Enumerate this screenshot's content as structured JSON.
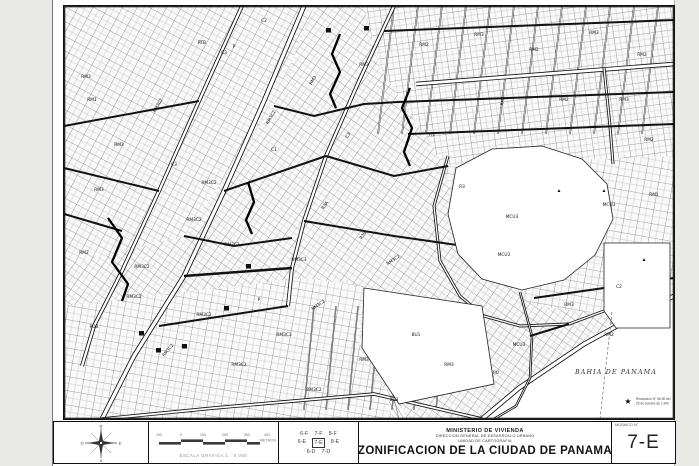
{
  "page": {
    "bg": "#e9e9e6",
    "sheet_bg": "#ffffff",
    "ink": "#1a1a1a"
  },
  "map": {
    "width": 610,
    "height": 413,
    "bay": {
      "label": "BAHIA DE PANAMA",
      "lx": 552,
      "ly": 368,
      "pts": [
        [
          418,
          413
        ],
        [
          452,
          384
        ],
        [
          505,
          344
        ],
        [
          562,
          310
        ],
        [
          610,
          286
        ],
        [
          610,
          413
        ]
      ]
    },
    "note": {
      "star": "★",
      "line1": "Resolucion N° 55-90 del",
      "line2": "26 de octubre de 1,990",
      "x": 564,
      "y": 394
    },
    "patterns": [
      {
        "id": "p1",
        "s": 13,
        "rot": 28
      },
      {
        "id": "p2",
        "s": 12,
        "rot": -8
      },
      {
        "id": "p3",
        "s": 12,
        "rot": 35
      },
      {
        "id": "p4",
        "s": 14,
        "rot": 10
      }
    ],
    "districts": [
      {
        "pat": "p3",
        "pts": [
          [
            0,
            0
          ],
          [
            610,
            0
          ],
          [
            610,
            413
          ],
          [
            0,
            413
          ]
        ]
      },
      {
        "pat": "p1",
        "pts": [
          [
            0,
            0
          ],
          [
            250,
            0
          ],
          [
            210,
            100
          ],
          [
            120,
            230
          ],
          [
            0,
            260
          ]
        ]
      },
      {
        "pat": "p2",
        "pts": [
          [
            300,
            0
          ],
          [
            610,
            0
          ],
          [
            610,
            150
          ],
          [
            380,
            160
          ],
          [
            315,
            60
          ]
        ]
      },
      {
        "pat": "p4",
        "pts": [
          [
            380,
            160
          ],
          [
            610,
            150
          ],
          [
            610,
            285
          ],
          [
            560,
            310
          ],
          [
            470,
            300
          ],
          [
            400,
            240
          ]
        ]
      },
      {
        "pat": "p4",
        "pts": [
          [
            0,
            300
          ],
          [
            240,
            272
          ],
          [
            300,
            280
          ],
          [
            295,
            340
          ],
          [
            330,
            400
          ],
          [
            330,
            413
          ],
          [
            0,
            413
          ]
        ]
      }
    ],
    "open_areas": [
      {
        "name": "park",
        "pts": [
          [
            392,
            162
          ],
          [
            428,
            143
          ],
          [
            478,
            140
          ],
          [
            518,
            153
          ],
          [
            543,
            178
          ],
          [
            549,
            213
          ],
          [
            531,
            249
          ],
          [
            500,
            274
          ],
          [
            458,
            284
          ],
          [
            418,
            273
          ],
          [
            394,
            248
          ],
          [
            384,
            208
          ]
        ]
      },
      {
        "name": "valley",
        "pts": [
          [
            300,
            282
          ],
          [
            418,
            300
          ],
          [
            430,
            378
          ],
          [
            335,
            398
          ],
          [
            298,
            342
          ]
        ]
      },
      {
        "name": "convention-block",
        "pts": [
          [
            540,
            237
          ],
          [
            606,
            237
          ],
          [
            606,
            322
          ],
          [
            552,
            322
          ],
          [
            540,
            305
          ]
        ]
      }
    ],
    "river": {
      "pts": [
        [
          318,
          288
        ],
        [
          310,
          310
        ],
        [
          318,
          335
        ],
        [
          330,
          358
        ],
        [
          328,
          385
        ],
        [
          335,
          413
        ]
      ]
    },
    "streams": [
      {
        "p": [
          [
            276,
            28
          ],
          [
            268,
            48
          ],
          [
            276,
            66
          ],
          [
            266,
            88
          ],
          [
            272,
            102
          ]
        ]
      },
      {
        "p": [
          [
            346,
            82
          ],
          [
            338,
            102
          ],
          [
            348,
            122
          ],
          [
            340,
            146
          ],
          [
            346,
            160
          ]
        ]
      },
      {
        "p": [
          [
            44,
            212
          ],
          [
            58,
            232
          ],
          [
            48,
            256
          ],
          [
            64,
            278
          ],
          [
            58,
            295
          ]
        ]
      },
      {
        "p": [
          [
            184,
            176
          ],
          [
            190,
            196
          ],
          [
            182,
            214
          ],
          [
            188,
            228
          ]
        ]
      }
    ],
    "roads": [
      {
        "w": 5,
        "d": 1,
        "p": [
          [
            240,
            0
          ],
          [
            200,
            95
          ],
          [
            160,
            185
          ],
          [
            120,
            270
          ],
          [
            70,
            350
          ],
          [
            38,
            413
          ]
        ]
      },
      {
        "w": 4,
        "d": 1,
        "p": [
          [
            178,
            0
          ],
          [
            135,
            95
          ],
          [
            95,
            185
          ],
          [
            58,
            265
          ],
          [
            30,
            320
          ],
          [
            18,
            360
          ]
        ]
      },
      {
        "w": 4,
        "d": 1,
        "p": [
          [
            330,
            0
          ],
          [
            295,
            75
          ],
          [
            262,
            150
          ],
          [
            240,
            215
          ],
          [
            228,
            262
          ],
          [
            224,
            300
          ]
        ]
      },
      {
        "w": 4.5,
        "d": 1,
        "p": [
          [
            352,
            78
          ],
          [
            610,
            58
          ]
        ]
      },
      {
        "w": 5,
        "d": 1,
        "p": [
          [
            418,
            413
          ],
          [
            455,
            382
          ],
          [
            520,
            338
          ],
          [
            575,
            308
          ],
          [
            610,
            290
          ]
        ]
      },
      {
        "w": 3,
        "d": 1,
        "p": [
          [
            384,
            150
          ],
          [
            370,
            200
          ],
          [
            376,
            255
          ],
          [
            396,
            290
          ],
          [
            420,
            310
          ],
          [
            456,
            320
          ],
          [
            505,
            318
          ],
          [
            540,
            305
          ]
        ]
      },
      {
        "w": 3,
        "d": 1,
        "p": [
          [
            540,
            62
          ],
          [
            546,
            120
          ],
          [
            549,
            158
          ]
        ]
      },
      {
        "w": 3.5,
        "d": 1,
        "p": [
          [
            38,
            413
          ],
          [
            150,
            402
          ],
          [
            230,
            395
          ],
          [
            310,
            388
          ],
          [
            418,
            413
          ]
        ]
      },
      {
        "w": 2.5,
        "d": 1,
        "p": [
          [
            456,
            286
          ],
          [
            468,
            330
          ],
          [
            466,
            372
          ],
          [
            452,
            400
          ],
          [
            430,
            413
          ]
        ]
      },
      {
        "w": 2,
        "d": 0,
        "p": [
          [
            320,
            25
          ],
          [
            610,
            14
          ]
        ]
      },
      {
        "w": 2,
        "d": 0,
        "p": [
          [
            334,
            96
          ],
          [
            610,
            86
          ]
        ]
      },
      {
        "w": 2,
        "d": 0,
        "p": [
          [
            344,
            128
          ],
          [
            610,
            118
          ]
        ]
      },
      {
        "w": 2,
        "d": 0,
        "p": [
          [
            0,
            120
          ],
          [
            135,
            95
          ]
        ]
      },
      {
        "w": 2,
        "d": 0,
        "p": [
          [
            0,
            162
          ],
          [
            95,
            185
          ]
        ]
      },
      {
        "w": 2,
        "d": 0,
        "p": [
          [
            0,
            208
          ],
          [
            58,
            225
          ]
        ]
      },
      {
        "w": 2,
        "d": 0,
        "p": [
          [
            160,
            185
          ],
          [
            262,
            150
          ]
        ]
      },
      {
        "w": 2.5,
        "d": 0,
        "p": [
          [
            120,
            270
          ],
          [
            228,
            262
          ]
        ]
      },
      {
        "w": 2,
        "d": 0,
        "p": [
          [
            95,
            320
          ],
          [
            224,
            300
          ]
        ]
      },
      {
        "w": 2,
        "d": 0,
        "p": [
          [
            470,
            292
          ],
          [
            610,
            272
          ]
        ]
      },
      {
        "w": 2,
        "d": 0,
        "p": [
          [
            466,
            330
          ],
          [
            505,
            318
          ]
        ]
      },
      {
        "w": 2,
        "d": 0,
        "p": [
          [
            210,
            100
          ],
          [
            250,
            110
          ],
          [
            300,
            98
          ],
          [
            334,
            96
          ]
        ]
      },
      {
        "w": 2,
        "d": 0,
        "p": [
          [
            120,
            230
          ],
          [
            170,
            240
          ],
          [
            228,
            232
          ]
        ]
      },
      {
        "w": 2,
        "d": 0,
        "p": [
          [
            262,
            150
          ],
          [
            330,
            170
          ],
          [
            384,
            160
          ]
        ]
      },
      {
        "w": 2,
        "d": 0,
        "p": [
          [
            240,
            215
          ],
          [
            330,
            230
          ],
          [
            400,
            240
          ]
        ]
      }
    ],
    "grids": [
      {
        "x0": 330,
        "x1": 602,
        "step": 24,
        "dx": -16,
        "y0": 0,
        "y1": 128,
        "w": 1.5
      },
      {
        "x0": 250,
        "x1": 396,
        "step": 22,
        "dx": -10,
        "y0": 300,
        "y1": 404,
        "w": 1.3
      }
    ],
    "dashed": [
      [
        548,
        306
      ],
      [
        536,
        413
      ]
    ],
    "labels": [
      {
        "t": "RM3",
        "x": 22,
        "y": 72
      },
      {
        "t": "C2",
        "x": 200,
        "y": 16
      },
      {
        "t": "C3",
        "x": 160,
        "y": 48
      },
      {
        "t": "RM3C2",
        "x": 95,
        "y": 100,
        "r": -60
      },
      {
        "t": "RTB",
        "x": 138,
        "y": 38
      },
      {
        "t": "P",
        "x": 170,
        "y": 42
      },
      {
        "t": "RM1",
        "x": 28,
        "y": 95
      },
      {
        "t": "RM3",
        "x": 55,
        "y": 140
      },
      {
        "t": "C3",
        "x": 110,
        "y": 160
      },
      {
        "t": "RM3C2",
        "x": 145,
        "y": 178
      },
      {
        "t": "RM3",
        "x": 35,
        "y": 185
      },
      {
        "t": "RM2",
        "x": 20,
        "y": 248
      },
      {
        "t": "RM3C2",
        "x": 78,
        "y": 262
      },
      {
        "t": "PUB",
        "x": 30,
        "y": 322
      },
      {
        "t": "RM3C2",
        "x": 70,
        "y": 292
      },
      {
        "t": "RM3C2",
        "x": 105,
        "y": 345,
        "r": -50
      },
      {
        "t": "RM3C2",
        "x": 140,
        "y": 310
      },
      {
        "t": "RM3C2",
        "x": 175,
        "y": 360
      },
      {
        "t": "RM3C3",
        "x": 220,
        "y": 330
      },
      {
        "t": "RM3C2",
        "x": 250,
        "y": 385
      },
      {
        "t": "RM3C2",
        "x": 255,
        "y": 300,
        "r": -35
      },
      {
        "t": "RM3C3",
        "x": 235,
        "y": 255
      },
      {
        "t": "P",
        "x": 195,
        "y": 295
      },
      {
        "t": "RM3C3",
        "x": 168,
        "y": 240
      },
      {
        "t": "RM3C2",
        "x": 130,
        "y": 215
      },
      {
        "t": "RM3C2",
        "x": 208,
        "y": 112,
        "r": -60
      },
      {
        "t": "RM3",
        "x": 250,
        "y": 75,
        "r": -60
      },
      {
        "t": "R3A",
        "x": 262,
        "y": 200,
        "r": -55
      },
      {
        "t": "R3B",
        "x": 300,
        "y": 230,
        "r": -55
      },
      {
        "t": "C3",
        "x": 285,
        "y": 130,
        "r": -55
      },
      {
        "t": "RM3C2",
        "x": 330,
        "y": 255,
        "r": -35
      },
      {
        "t": "BU1",
        "x": 352,
        "y": 330
      },
      {
        "t": "RM3",
        "x": 300,
        "y": 60
      },
      {
        "t": "RM2",
        "x": 360,
        "y": 40
      },
      {
        "t": "RM3",
        "x": 415,
        "y": 30
      },
      {
        "t": "RM2",
        "x": 470,
        "y": 45
      },
      {
        "t": "RM3",
        "x": 530,
        "y": 28
      },
      {
        "t": "RM2",
        "x": 578,
        "y": 50
      },
      {
        "t": "RM1",
        "x": 440,
        "y": 95,
        "r": -80
      },
      {
        "t": "RM2",
        "x": 500,
        "y": 95
      },
      {
        "t": "RM3",
        "x": 560,
        "y": 95
      },
      {
        "t": "R3",
        "x": 368,
        "y": 130
      },
      {
        "t": "R3",
        "x": 398,
        "y": 182
      },
      {
        "t": "MCU3",
        "x": 448,
        "y": 212
      },
      {
        "t": "MCU3",
        "x": 440,
        "y": 250
      },
      {
        "t": "RM2",
        "x": 585,
        "y": 135
      },
      {
        "t": "RM1",
        "x": 590,
        "y": 190
      },
      {
        "t": "MCU3",
        "x": 545,
        "y": 200
      },
      {
        "t": "RM3",
        "x": 505,
        "y": 300
      },
      {
        "t": "MCU3",
        "x": 455,
        "y": 340
      },
      {
        "t": "RM2",
        "x": 545,
        "y": 330
      },
      {
        "t": "PU",
        "x": 432,
        "y": 368
      },
      {
        "t": "RM3",
        "x": 385,
        "y": 360
      },
      {
        "t": "BU3",
        "x": 330,
        "y": 395
      },
      {
        "t": "RM3",
        "x": 300,
        "y": 355
      },
      {
        "t": "C2",
        "x": 555,
        "y": 282
      },
      {
        "t": "C1",
        "x": 210,
        "y": 145
      }
    ],
    "symbols": {
      "triangles": [
        [
          495,
          186
        ],
        [
          540,
          186
        ],
        [
          580,
          255
        ]
      ],
      "blocks": [
        [
          182,
          258
        ],
        [
          75,
          325
        ],
        [
          92,
          342
        ],
        [
          118,
          338
        ],
        [
          262,
          22
        ],
        [
          300,
          20
        ],
        [
          160,
          300
        ]
      ]
    }
  },
  "footer": {
    "compass": {
      "n": "N",
      "s": "S",
      "e": "E",
      "w": "O"
    },
    "scale": {
      "ticks": [
        "100",
        "0",
        "100",
        "200",
        "300",
        "400"
      ],
      "unit": "METROS",
      "caption": "ESCALA GRAFICA 1 : 5,000"
    },
    "grid_index": {
      "rows": [
        [
          "6-F",
          "7-F",
          "8-F"
        ],
        [
          "6-E",
          "7-E",
          "8-E"
        ],
        [
          "6-D",
          "7-D"
        ]
      ],
      "current": "7-E"
    },
    "title_block": {
      "ministry": "MINISTERIO DE VIVIENDA",
      "direction": "DIRECCION GENERAL DE DESARROLLO URBANO",
      "unit": "UNIDAD DE CARTOGRAFIA",
      "title": "ZONIFICACION DE LA CIUDAD DE PANAMA"
    },
    "mosaic": {
      "label": "MOSAICO N°",
      "value": "7-E"
    }
  }
}
